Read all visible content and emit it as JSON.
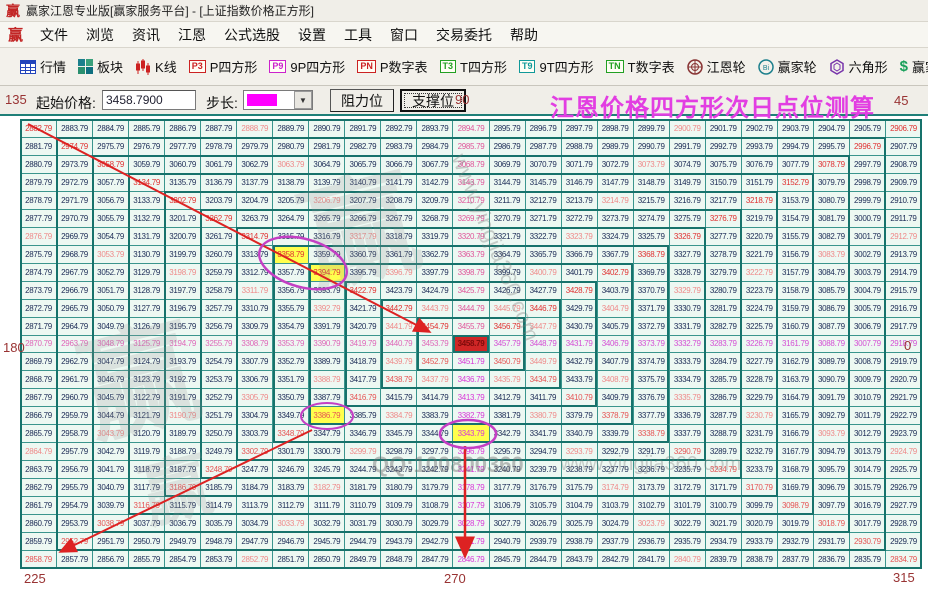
{
  "titlebar": {
    "title": "赢家江恩专业版[赢家服务平台] - [上证指数价格正方形]"
  },
  "brand": {
    "logo_char": "赢"
  },
  "menu": {
    "items": [
      "文件",
      "浏览",
      "资讯",
      "江恩",
      "公式选股",
      "设置",
      "工具",
      "窗口",
      "交易委托",
      "帮助"
    ]
  },
  "toolbar": {
    "items": [
      {
        "icon": "table",
        "label": "行情"
      },
      {
        "icon": "blocks",
        "label": "板块"
      },
      {
        "icon": "kline",
        "label": "K线"
      },
      {
        "chip": "P3",
        "chip_color": "#cc2222",
        "label": "P四方形"
      },
      {
        "chip": "P9",
        "chip_color": "#cc22cc",
        "label": "9P四方形"
      },
      {
        "chip": "PN",
        "chip_color": "#cc2222",
        "label": "P数字表"
      },
      {
        "chip": "T3",
        "chip_color": "#22a022",
        "label": "T四方形"
      },
      {
        "chip": "T9",
        "chip_color": "#119999",
        "label": "9T四方形"
      },
      {
        "chip": "TN",
        "chip_color": "#22a022",
        "label": "T数字表"
      },
      {
        "icon": "wheel",
        "label": "江恩轮"
      },
      {
        "icon": "winwheel",
        "label": "赢家轮"
      },
      {
        "icon": "hexagon",
        "label": "六角形"
      },
      {
        "icon": "dollar",
        "label": "赢家服务"
      }
    ]
  },
  "controls": {
    "start_price_label": "起始价格:",
    "start_price_value": "3458.7900",
    "step_label": "步长:",
    "step_swatch_color": "#ff00ff",
    "resistance_label": "阻力位",
    "support_label": "支撑位",
    "heading": "江恩价格四方形次日点位测算"
  },
  "angles": {
    "top_left": "135",
    "top_center": "90",
    "top_right": "45",
    "left": "180",
    "right": "0",
    "bottom_left": "225",
    "bottom_center": "270",
    "bottom_right": "315"
  },
  "watermarks": {
    "qq": "QQ:100800360",
    "site": "www.yingjia360.com"
  },
  "grid": {
    "rows": 25,
    "cols": 25,
    "center_value": "3458.79",
    "step": "1.00",
    "cells": [
      [
        "2882.79",
        "2883.79",
        "2884.79",
        "2885.79",
        "2886.79",
        "2887.79",
        "2888.79",
        "2889.79",
        "2890.79",
        "2891.79",
        "2892.79",
        "2893.79",
        "2894.79",
        "2895.79",
        "2896.79",
        "2897.79",
        "2898.79",
        "2899.79",
        "2900.79",
        "2901.79",
        "2902.79",
        "2903.79",
        "2904.79",
        "2905.79",
        "2906.79"
      ],
      [
        "2881.79",
        "2974.79",
        "2975.79",
        "2976.79",
        "2977.79",
        "2978.79",
        "2979.79",
        "2980.79",
        "2981.79",
        "2982.79",
        "2983.79",
        "2984.79",
        "2985.79",
        "2986.79",
        "2987.79",
        "2988.79",
        "2989.79",
        "2990.79",
        "2991.79",
        "2992.79",
        "2993.79",
        "2994.79",
        "2995.79",
        "2996.79",
        "2907.79"
      ],
      [
        "2880.79",
        "2973.79",
        "3058.79",
        "3059.79",
        "3060.79",
        "3061.79",
        "3062.79",
        "3063.79",
        "3064.79",
        "3065.79",
        "3066.79",
        "3067.79",
        "3068.79",
        "3069.79",
        "3070.79",
        "3071.79",
        "3072.79",
        "3073.79",
        "3074.79",
        "3075.79",
        "3076.79",
        "3077.79",
        "3078.79",
        "2997.79",
        "2908.79"
      ],
      [
        "2879.79",
        "2972.79",
        "3057.79",
        "3134.79",
        "3135.79",
        "3136.79",
        "3137.79",
        "3138.79",
        "3139.79",
        "3140.79",
        "3141.79",
        "3142.79",
        "3143.79",
        "3144.79",
        "3145.79",
        "3146.79",
        "3147.79",
        "3148.79",
        "3149.79",
        "3150.79",
        "3151.79",
        "3152.79",
        "3079.79",
        "2998.79",
        "2909.79"
      ],
      [
        "2878.79",
        "2971.79",
        "3056.79",
        "3133.79",
        "3202.79",
        "3203.79",
        "3204.79",
        "3205.79",
        "3206.79",
        "3207.79",
        "3208.79",
        "3209.79",
        "3210.79",
        "3211.79",
        "3212.79",
        "3213.79",
        "3214.79",
        "3215.79",
        "3216.79",
        "3217.79",
        "3218.79",
        "3153.79",
        "3080.79",
        "2999.79",
        "2910.79"
      ],
      [
        "2877.79",
        "2970.79",
        "3055.79",
        "3132.79",
        "3201.79",
        "3262.79",
        "3263.79",
        "3264.79",
        "3265.79",
        "3266.79",
        "3267.79",
        "3268.79",
        "3269.79",
        "3270.79",
        "3271.79",
        "3272.79",
        "3273.79",
        "3274.79",
        "3275.79",
        "3276.79",
        "3219.79",
        "3154.79",
        "3081.79",
        "3000.79",
        "2911.79"
      ],
      [
        "2876.79",
        "2969.79",
        "3054.79",
        "3131.79",
        "3200.79",
        "3261.79",
        "3314.79",
        "3315.79",
        "3316.79",
        "3317.79",
        "3318.79",
        "3319.79",
        "3320.79",
        "3321.79",
        "3322.79",
        "3323.79",
        "3324.79",
        "3325.79",
        "3326.79",
        "3277.79",
        "3220.79",
        "3155.79",
        "3082.79",
        "3001.79",
        "2912.79"
      ],
      [
        "2875.79",
        "2968.79",
        "3053.79",
        "3130.79",
        "3199.79",
        "3260.79",
        "3313.79",
        "3358.79",
        "3359.79",
        "3360.79",
        "3361.79",
        "3362.79",
        "3363.79",
        "3364.79",
        "3365.79",
        "3366.79",
        "3367.79",
        "3368.79",
        "3327.79",
        "3278.79",
        "3221.79",
        "3156.79",
        "3083.79",
        "3002.79",
        "2913.79"
      ],
      [
        "2874.79",
        "2967.79",
        "3052.79",
        "3129.79",
        "3198.79",
        "3259.79",
        "3312.79",
        "3357.79",
        "3394.79",
        "3395.79",
        "3396.79",
        "3397.79",
        "3398.79",
        "3399.79",
        "3400.79",
        "3401.79",
        "3402.79",
        "3369.79",
        "3328.79",
        "3279.79",
        "3222.79",
        "3157.79",
        "3084.79",
        "3003.79",
        "2914.79"
      ],
      [
        "2873.79",
        "2966.79",
        "3051.79",
        "3128.79",
        "3197.79",
        "3258.79",
        "3311.79",
        "3356.79",
        "3393.79",
        "3422.79",
        "3423.79",
        "3424.79",
        "3425.79",
        "3426.79",
        "3427.79",
        "3428.79",
        "3403.79",
        "3370.79",
        "3329.79",
        "3280.79",
        "3223.79",
        "3158.79",
        "3085.79",
        "3004.79",
        "2915.79"
      ],
      [
        "2872.79",
        "2965.79",
        "3050.79",
        "3127.79",
        "3196.79",
        "3257.79",
        "3310.79",
        "3355.79",
        "3392.79",
        "3421.79",
        "3442.79",
        "3443.79",
        "3444.79",
        "3445.79",
        "3446.79",
        "3429.79",
        "3404.79",
        "3371.79",
        "3330.79",
        "3281.79",
        "3224.79",
        "3159.79",
        "3086.79",
        "3005.79",
        "2916.79"
      ],
      [
        "2871.79",
        "2964.79",
        "3049.79",
        "3126.79",
        "3195.79",
        "3256.79",
        "3309.79",
        "3354.79",
        "3391.79",
        "3420.79",
        "3441.79",
        "3454.79",
        "3455.79",
        "3456.79",
        "3447.79",
        "3430.79",
        "3405.79",
        "3372.79",
        "3331.79",
        "3282.79",
        "3225.79",
        "3160.79",
        "3087.79",
        "3006.79",
        "2917.79"
      ],
      [
        "2870.79",
        "2963.79",
        "3048.79",
        "3125.79",
        "3194.79",
        "3255.79",
        "3308.79",
        "3353.79",
        "3390.79",
        "3419.79",
        "3440.79",
        "3453.79",
        "3458.79",
        "3457.79",
        "3448.79",
        "3431.79",
        "3406.79",
        "3373.79",
        "3332.79",
        "3283.79",
        "3226.79",
        "3161.79",
        "3088.79",
        "3007.79",
        "2918.79"
      ],
      [
        "2869.79",
        "2962.79",
        "3047.79",
        "3124.79",
        "3193.79",
        "3254.79",
        "3307.79",
        "3352.79",
        "3389.79",
        "3418.79",
        "3439.79",
        "3452.79",
        "3451.79",
        "3450.79",
        "3449.79",
        "3432.79",
        "3407.79",
        "3374.79",
        "3333.79",
        "3284.79",
        "3227.79",
        "3162.79",
        "3089.79",
        "3008.79",
        "2919.79"
      ],
      [
        "2868.79",
        "2961.79",
        "3046.79",
        "3123.79",
        "3192.79",
        "3253.79",
        "3306.79",
        "3351.79",
        "3388.79",
        "3417.79",
        "3438.79",
        "3437.79",
        "3436.79",
        "3435.79",
        "3434.79",
        "3433.79",
        "3408.79",
        "3375.79",
        "3334.79",
        "3285.79",
        "3228.79",
        "3163.79",
        "3090.79",
        "3009.79",
        "2920.79"
      ],
      [
        "2867.79",
        "2960.79",
        "3045.79",
        "3122.79",
        "3191.79",
        "3252.79",
        "3305.79",
        "3350.79",
        "3387.79",
        "3416.79",
        "3415.79",
        "3414.79",
        "3413.79",
        "3412.79",
        "3411.79",
        "3410.79",
        "3409.79",
        "3376.79",
        "3335.79",
        "3286.79",
        "3229.79",
        "3164.79",
        "3091.79",
        "3010.79",
        "2921.79"
      ],
      [
        "2866.79",
        "2959.79",
        "3044.79",
        "3121.79",
        "3190.79",
        "3251.79",
        "3304.79",
        "3349.79",
        "3386.79",
        "3385.79",
        "3384.79",
        "3383.79",
        "3382.79",
        "3381.79",
        "3380.79",
        "3379.79",
        "3378.79",
        "3377.79",
        "3336.79",
        "3287.79",
        "3230.79",
        "3165.79",
        "3092.79",
        "3011.79",
        "2922.79"
      ],
      [
        "2865.79",
        "2958.79",
        "3043.79",
        "3120.79",
        "3189.79",
        "3250.79",
        "3303.79",
        "3348.79",
        "3347.79",
        "3346.79",
        "3345.79",
        "3344.79",
        "3343.79",
        "3342.79",
        "3341.79",
        "3340.79",
        "3339.79",
        "3338.79",
        "3337.79",
        "3288.79",
        "3231.79",
        "3166.79",
        "3093.79",
        "3012.79",
        "2923.79"
      ],
      [
        "2864.79",
        "2957.79",
        "3042.79",
        "3119.79",
        "3188.79",
        "3249.79",
        "3302.79",
        "3301.79",
        "3300.79",
        "3299.79",
        "3298.79",
        "3297.79",
        "3296.79",
        "3295.79",
        "3294.79",
        "3293.79",
        "3292.79",
        "3291.79",
        "3290.79",
        "3289.79",
        "3232.79",
        "3167.79",
        "3094.79",
        "3013.79",
        "2924.79"
      ],
      [
        "2863.79",
        "2956.79",
        "3041.79",
        "3118.79",
        "3187.79",
        "3248.79",
        "3247.79",
        "3246.79",
        "3245.79",
        "3244.79",
        "3243.79",
        "3242.79",
        "3241.79",
        "3240.79",
        "3239.79",
        "3238.79",
        "3237.79",
        "3236.79",
        "3235.79",
        "3234.79",
        "3233.79",
        "3168.79",
        "3095.79",
        "3014.79",
        "2925.79"
      ],
      [
        "2862.79",
        "2955.79",
        "3040.79",
        "3117.79",
        "3186.79",
        "3185.79",
        "3184.79",
        "3183.79",
        "3182.79",
        "3181.79",
        "3180.79",
        "3179.79",
        "3178.79",
        "3177.79",
        "3176.79",
        "3175.79",
        "3174.79",
        "3173.79",
        "3172.79",
        "3171.79",
        "3170.79",
        "3169.79",
        "3096.79",
        "3015.79",
        "2926.79"
      ],
      [
        "2861.79",
        "2954.79",
        "3039.79",
        "3116.79",
        "3115.79",
        "3114.79",
        "3113.79",
        "3112.79",
        "3111.79",
        "3110.79",
        "3109.79",
        "3108.79",
        "3107.79",
        "3106.79",
        "3105.79",
        "3104.79",
        "3103.79",
        "3102.79",
        "3101.79",
        "3100.79",
        "3099.79",
        "3098.79",
        "3097.79",
        "3016.79",
        "2927.79"
      ],
      [
        "2860.79",
        "2953.79",
        "3038.79",
        "3037.79",
        "3036.79",
        "3035.79",
        "3034.79",
        "3033.79",
        "3032.79",
        "3031.79",
        "3030.79",
        "3029.79",
        "3028.79",
        "3027.79",
        "3026.79",
        "3025.79",
        "3024.79",
        "3023.79",
        "3022.79",
        "3021.79",
        "3020.79",
        "3019.79",
        "3018.79",
        "3017.79",
        "2928.79"
      ],
      [
        "2859.79",
        "2952.79",
        "2951.79",
        "2950.79",
        "2949.79",
        "2948.79",
        "2947.79",
        "2946.79",
        "2945.79",
        "2944.79",
        "2943.79",
        "2942.79",
        "2941.79",
        "2940.79",
        "2939.79",
        "2938.79",
        "2937.79",
        "2936.79",
        "2935.79",
        "2934.79",
        "2933.79",
        "2932.79",
        "2931.79",
        "2930.79",
        "2929.79"
      ],
      [
        "2858.79",
        "2857.79",
        "2856.79",
        "2855.79",
        "2854.79",
        "2853.79",
        "2852.79",
        "2851.79",
        "2850.79",
        "2849.79",
        "2848.79",
        "2847.79",
        "2846.79",
        "2845.79",
        "2844.79",
        "2843.79",
        "2842.79",
        "2841.79",
        "2840.79",
        "2839.79",
        "2838.79",
        "2837.79",
        "2836.79",
        "2835.79",
        "2834.79"
      ]
    ]
  },
  "highlights": {
    "selected_value": "3458.79",
    "yellow_values": [
      "3394.79",
      "3358.79",
      "3386.79",
      "3343.79"
    ]
  },
  "colors": {
    "ray_red": "#e03232",
    "ray_90": "#e0559a",
    "ray_180": "#df66b8",
    "ray_0": "#d44fd4",
    "ray_270": "#d838d8",
    "ray_225": "#e65555",
    "ray_315": "#e65555",
    "gann_line": "#ef8a8a",
    "cell_text": "#1b2a55",
    "grid_line": "#3a958d",
    "ring_line": "#17726b",
    "grid_bg": "#edf8f2",
    "center_bg": "#cf2626",
    "center_text": "#7d0b0b",
    "yellow_bg": "#ffff4d",
    "accent_magenta": "#e23ee2",
    "label_brown": "#993333",
    "teal_rule": "#1f7f78",
    "arrow_red": "#dd2222",
    "ellipse_magenta": "#c43fc4"
  }
}
